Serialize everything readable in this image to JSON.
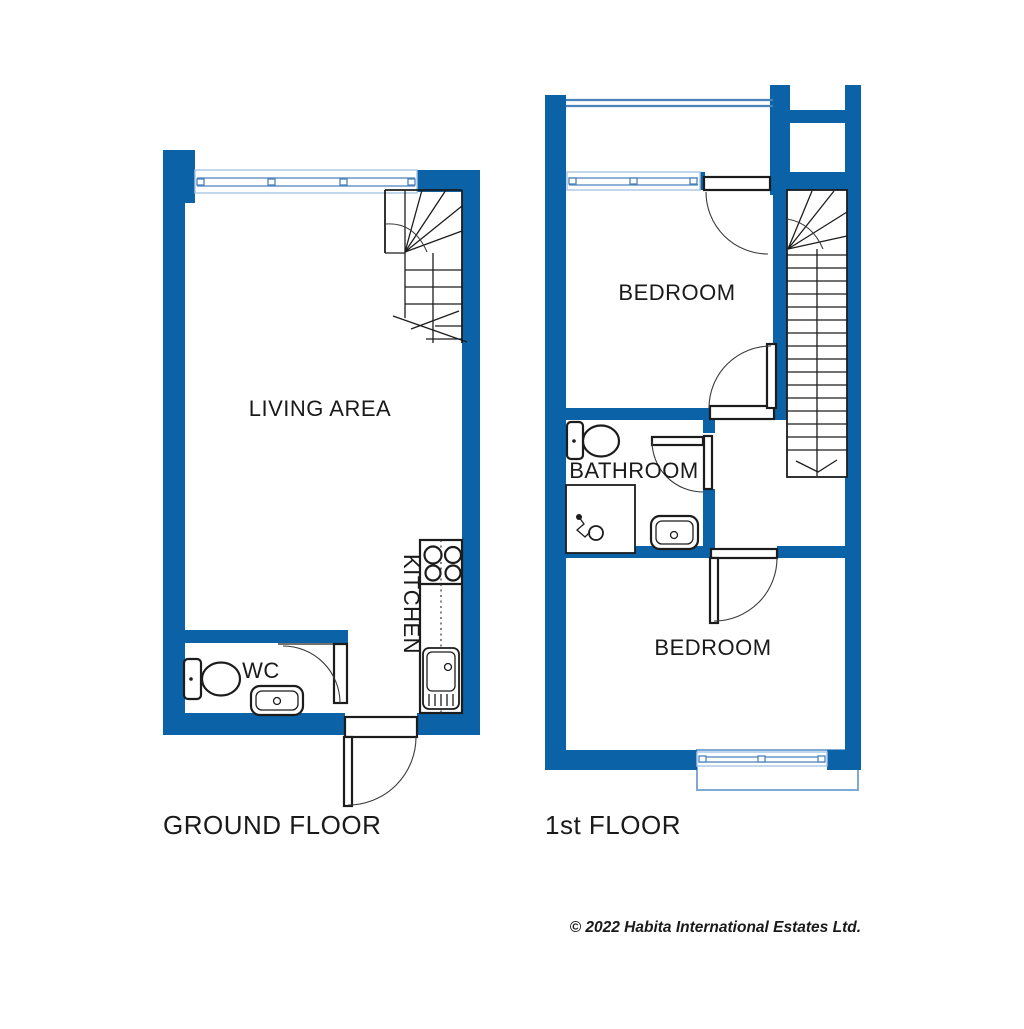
{
  "colors": {
    "wall": "#0b62a6",
    "line": "#1c1c1c",
    "winlight": "#a9c4e4",
    "winmid": "#4a82bc",
    "balcony": "#7fa8d4"
  },
  "ground_floor": {
    "label": "GROUND FLOOR",
    "living_area_label": "LIVING AREA",
    "kitchen_label": "KITCHEN",
    "wc_label": "WC"
  },
  "first_floor": {
    "label": "1st FLOOR",
    "bedroom1_label": "BEDROOM",
    "bathroom_label": "BATHROOM",
    "bedroom2_label": "BEDROOM"
  },
  "footer": {
    "copyright": "© 2022 Habita International Estates Ltd."
  }
}
